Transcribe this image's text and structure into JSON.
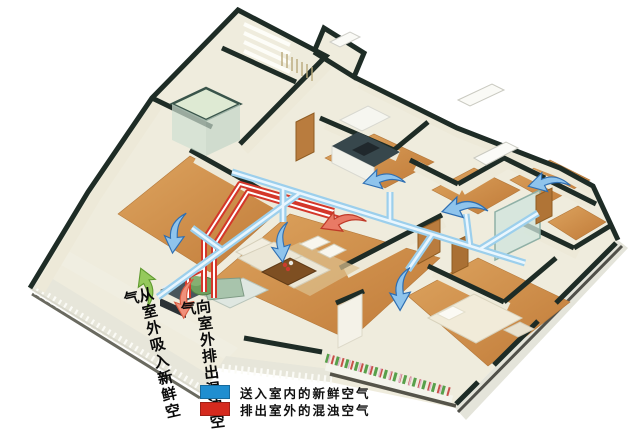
{
  "figure": {
    "kind": "home-ventilation-isometric-cutaway-illustration",
    "background": "#ffffff"
  },
  "annotations": {
    "intake": {
      "text": "从室外吸入新鲜空气"
    },
    "exhaust": {
      "text": "向室外排出混浊空气"
    }
  },
  "legend": {
    "items": [
      {
        "name": "fresh-air-supply",
        "label": "送入室内的新鲜空气",
        "color": "#1f8ed0",
        "swatch_style": "background:#1f8ed0"
      },
      {
        "name": "exhaust-air",
        "label": "排出室外的混浊空气",
        "color": "#d52a1e",
        "swatch_style": "background:#d52a1e"
      }
    ]
  },
  "colors": {
    "supply_duct": "#9ccfec",
    "exhaust_duct": "#d4372a",
    "wall_cap": "#1e2c26",
    "wall_face": "#ede9d8",
    "wood_floor": "#cd8c4a",
    "supply_arrow": "#8fc4ec",
    "exhaust_arrow_indoor": "#e97a65",
    "exhaust_arrow_outlet": "#f0907a",
    "intake_arrow": "#95c95c"
  },
  "icons": {
    "arrows": [
      "supply-arrow-bedroom-left",
      "supply-arrow-living-room",
      "supply-arrow-kitchen",
      "supply-arrow-room-mid-right",
      "supply-arrow-room-top-right",
      "supply-arrow-bedroom-bottom-right",
      "exhaust-arrow-indoor",
      "exhaust-arrow-outlet",
      "intake-arrow-inlet"
    ]
  }
}
